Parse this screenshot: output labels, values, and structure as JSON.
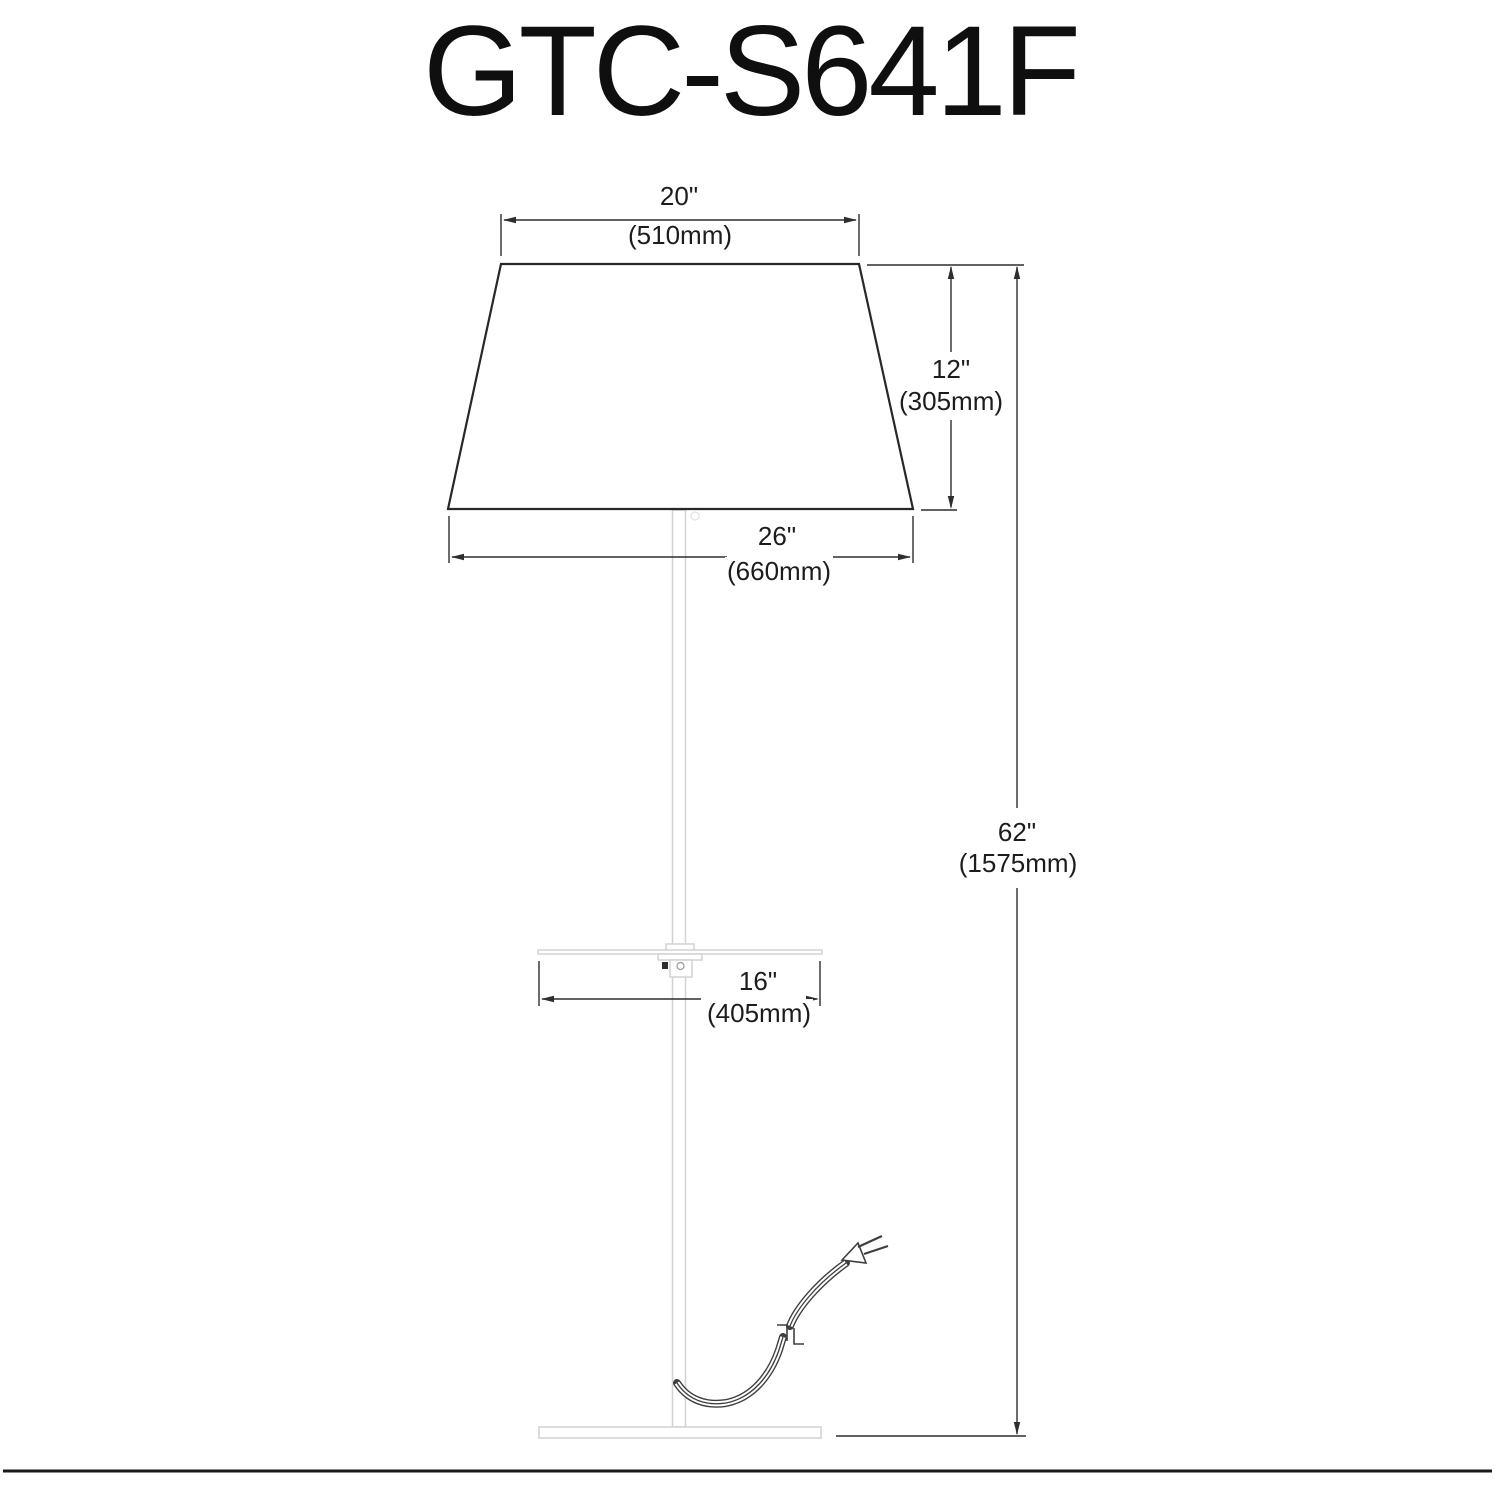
{
  "title": "GTC-S641F",
  "colors": {
    "ink": "#2e2e2e",
    "fixture_gray": "#d2d2d2",
    "background": "#ffffff"
  },
  "dimensions": {
    "shade_top_diameter": {
      "inches": "20\"",
      "mm": "(510mm)"
    },
    "shade_height": {
      "inches": "12\"",
      "mm": "(305mm)"
    },
    "shade_bottom_diameter": {
      "inches": "26\"",
      "mm": "(660mm)"
    },
    "tray_width": {
      "inches": "16\"",
      "mm": "(405mm)"
    },
    "overall_height": {
      "inches": "62\"",
      "mm": "(1575mm)"
    }
  }
}
